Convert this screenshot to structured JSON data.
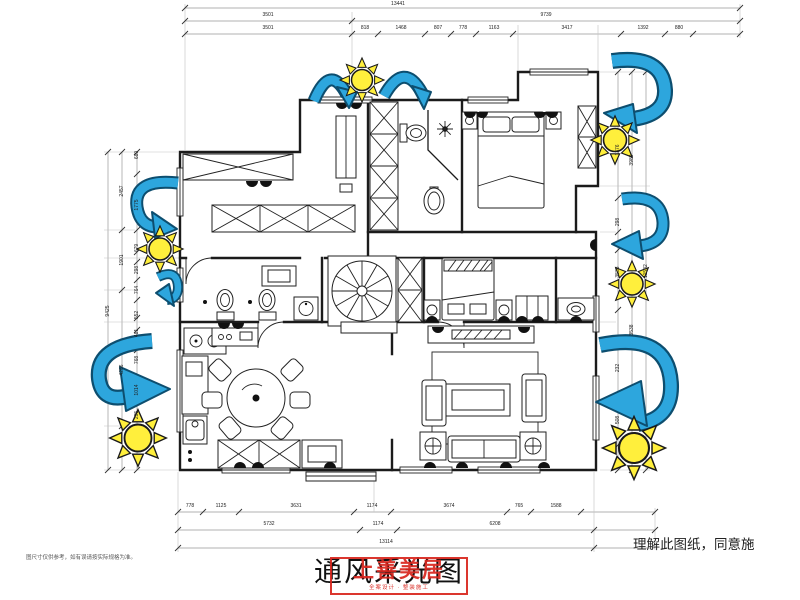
{
  "meta": {
    "title": "通风采光图",
    "note_right": "理解此图纸，同意施",
    "note_left": "图尺寸仅供参考，如有误请按实际规格为准。"
  },
  "watermark": {
    "line1": "上善美居",
    "line2": "全案设计 · 整装施工"
  },
  "colors": {
    "arrow": "#2da6dd",
    "arrow_outline": "#0d4e6f",
    "sun": "#ffef3c",
    "watermark": "#d8251d",
    "wall": "#1b1b1b"
  },
  "dims": {
    "top": {
      "total": "13441",
      "row2": [
        "3501",
        "9739"
      ],
      "row3": [
        "3501",
        "818",
        "1468",
        "807",
        "778",
        "1163",
        "3417",
        "1392",
        "880"
      ]
    },
    "bottom": {
      "row1": [
        "778",
        "1125",
        "3631",
        "1174",
        "3674",
        "765",
        "1588"
      ],
      "row2": [
        "5732",
        "1174",
        "6208"
      ],
      "total": "13114"
    },
    "left": {
      "total": "9425",
      "mid": [
        "2457",
        "1901",
        "4286"
      ],
      "inner": [
        "680",
        "1775",
        "679",
        "298",
        "764",
        "552",
        "481",
        "768",
        "1014",
        "295"
      ]
    },
    "right": {
      "total": "11582",
      "mid": [
        "3989",
        "3538"
      ],
      "inner": [
        "1376",
        "298",
        "3538",
        "232",
        "508"
      ]
    }
  }
}
